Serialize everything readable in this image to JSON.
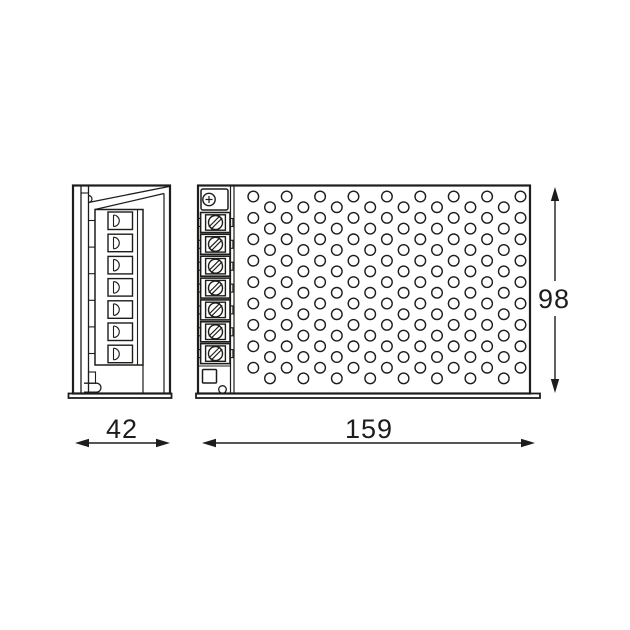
{
  "page": {
    "background": "#ffffff",
    "line_color": "#1d1d1b"
  },
  "drawing": {
    "type": "technical-dimension-drawing",
    "subject": "enclosed power supply unit, side view and front view",
    "dimensions": {
      "width_label": "42",
      "length_label": "159",
      "height_label": "98"
    },
    "side_view": {
      "terminal_slots": 7,
      "slot_y0": 212,
      "slot_pitch": 22.2,
      "seam_ticks": 6,
      "tick_y0": 220.5,
      "tick_pitch": 26.6
    },
    "front_view": {
      "terminal_blocks": 7,
      "block_y0": 212.5,
      "block_pitch": 21.85,
      "earth_terminal": true,
      "perforation": {
        "cols": 17,
        "rows_per_col": 9,
        "x0": 253.3,
        "dx": 16.7,
        "y_even": 196.5,
        "y_odd": 207.2,
        "dy": 21.4,
        "r": 5.3
      }
    }
  }
}
